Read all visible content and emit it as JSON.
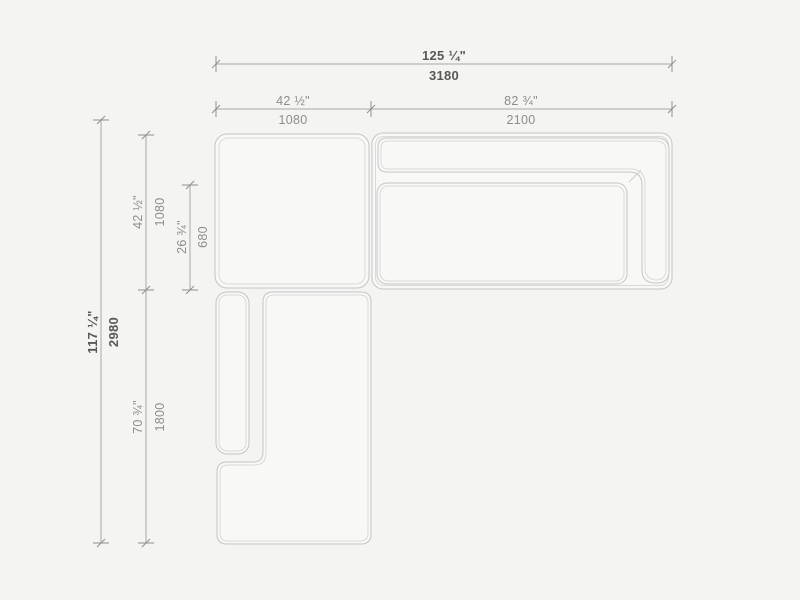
{
  "drawing": {
    "title": "sectional-sofa-plan-view",
    "units": [
      "inches",
      "mm"
    ],
    "modules": [
      "corner-module",
      "right-sofa-module",
      "left-chaise-module"
    ],
    "colors": {
      "background": "#f4f4f3",
      "furniture_outline": "#c5c5c4",
      "furniture_seam": "#dadad9",
      "dimension_line": "#a8a8a7",
      "dimension_text": "#8d8d8c",
      "dimension_text_strong": "#585857"
    },
    "dimensions": {
      "overall_width": {
        "inches": "125 ¼\"",
        "mm": "3180"
      },
      "corner_width": {
        "inches": "42 ½\"",
        "mm": "1080"
      },
      "sofa_width": {
        "inches": "82 ¾\"",
        "mm": "2100"
      },
      "overall_depth": {
        "inches": "117 ¼\"",
        "mm": "2980"
      },
      "corner_depth": {
        "inches": "42 ½\"",
        "mm": "1080"
      },
      "seat_depth": {
        "inches": "26 ¾\"",
        "mm": "680"
      },
      "chaise_length": {
        "inches": "70 ¾\"",
        "mm": "1800"
      }
    }
  }
}
